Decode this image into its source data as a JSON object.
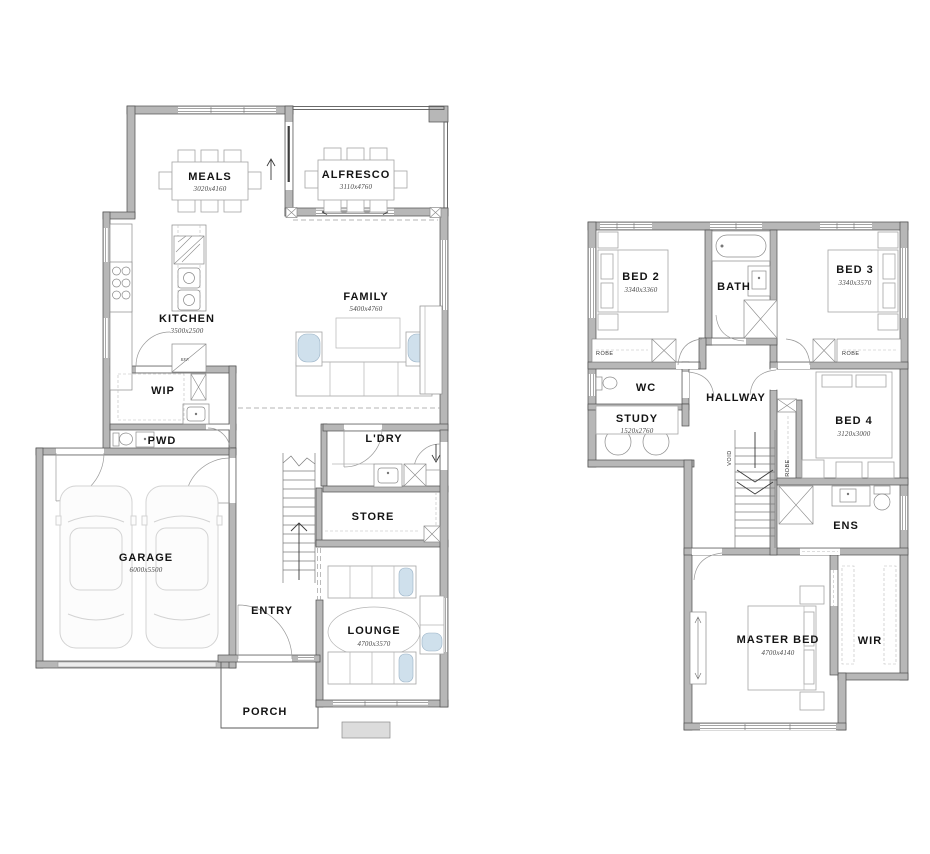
{
  "colors": {
    "wall_fill": "#b7b7b7",
    "wall_stroke": "#4e4e4e",
    "accent_blue": "#cfe0ec",
    "text": "#141414"
  },
  "ground_floor": {
    "rooms": [
      {
        "name": "meals",
        "label": "MEALS",
        "dims": "3020x4160"
      },
      {
        "name": "alfresco",
        "label": "ALFRESCO",
        "dims": "3110x4760"
      },
      {
        "name": "kitchen",
        "label": "KITCHEN",
        "dims": "3500x2500"
      },
      {
        "name": "family",
        "label": "FAMILY",
        "dims": "5400x4760"
      },
      {
        "name": "wip",
        "label": "WIP"
      },
      {
        "name": "pwd",
        "label": "PWD"
      },
      {
        "name": "ldry",
        "label": "L'DRY"
      },
      {
        "name": "garage",
        "label": "GARAGE",
        "dims": "6000x5500"
      },
      {
        "name": "store",
        "label": "STORE"
      },
      {
        "name": "entry",
        "label": "ENTRY"
      },
      {
        "name": "lounge",
        "label": "LOUNGE",
        "dims": "4700x3570"
      },
      {
        "name": "porch",
        "label": "PORCH"
      }
    ],
    "annotations": [
      {
        "name": "fridge",
        "label": "REF."
      }
    ]
  },
  "upper_floor": {
    "rooms": [
      {
        "name": "bed2",
        "label": "BED 2",
        "dims": "3340x3360"
      },
      {
        "name": "bath",
        "label": "BATH"
      },
      {
        "name": "bed3",
        "label": "BED 3",
        "dims": "3340x3570"
      },
      {
        "name": "wc",
        "label": "WC"
      },
      {
        "name": "hallway",
        "label": "HALLWAY"
      },
      {
        "name": "study",
        "label": "STUDY",
        "dims": "1520x2760"
      },
      {
        "name": "bed4",
        "label": "BED 4",
        "dims": "3120x3000"
      },
      {
        "name": "ens",
        "label": "ENS"
      },
      {
        "name": "master",
        "label": "MASTER BED",
        "dims": "4700x4140"
      },
      {
        "name": "wir",
        "label": "WIR"
      }
    ],
    "annotations": [
      {
        "name": "robe-bed2",
        "label": "ROBE"
      },
      {
        "name": "robe-bed3",
        "label": "ROBE"
      },
      {
        "name": "robe-bed4",
        "label": "ROBE"
      },
      {
        "name": "void",
        "label": "VOID"
      }
    ]
  }
}
